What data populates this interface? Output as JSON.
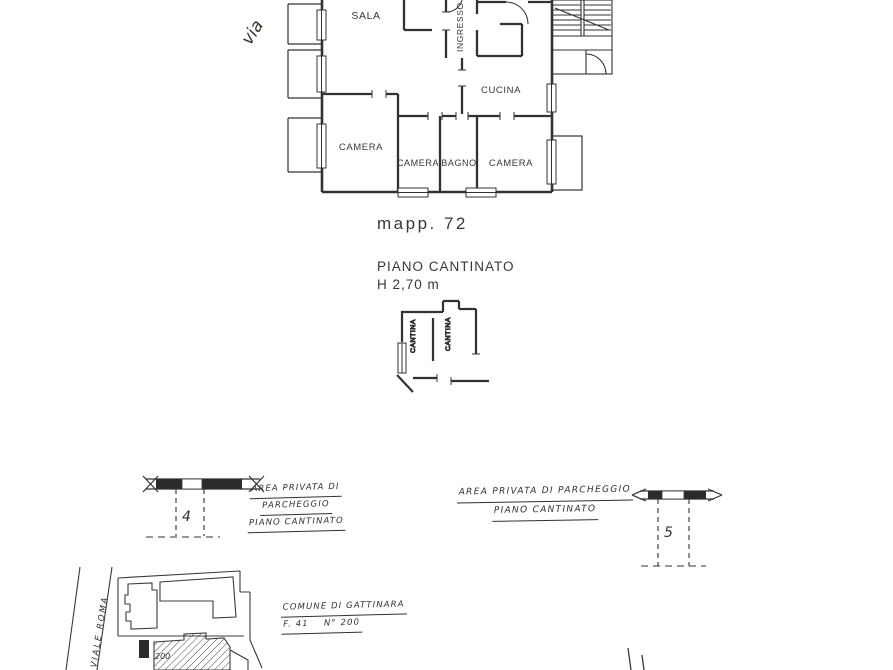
{
  "street_top": {
    "label": "via"
  },
  "floor_plan": {
    "rooms": {
      "sala": "SALA",
      "ingresso": "INGRESSO",
      "cucina": "CUCINA",
      "camera1": "CAMERA",
      "camera2": "CAMERA",
      "bagno": "BAGNO",
      "camera3": "CAMERA"
    },
    "parcel": "mapp. 72"
  },
  "basement": {
    "title": "PIANO CANTINATO",
    "height": "H 2,70 m",
    "rooms": {
      "cantina1": "CANTINA",
      "cantina2": "CANTINA"
    }
  },
  "parking_left": {
    "space_number": "4",
    "note": [
      "AREA PRIVATA DI",
      "PARCHEGGIO",
      "PIANO CANTINATO"
    ]
  },
  "parking_right": {
    "space_number": "5",
    "note": [
      "AREA PRIVATA DI PARCHEGGIO",
      "PIANO CANTINATO"
    ]
  },
  "site_map": {
    "street": "VIALE ROMA",
    "building_number": "200",
    "caption": [
      "COMUNE DI GATTINARA",
      "F. 41    N° 200"
    ]
  }
}
